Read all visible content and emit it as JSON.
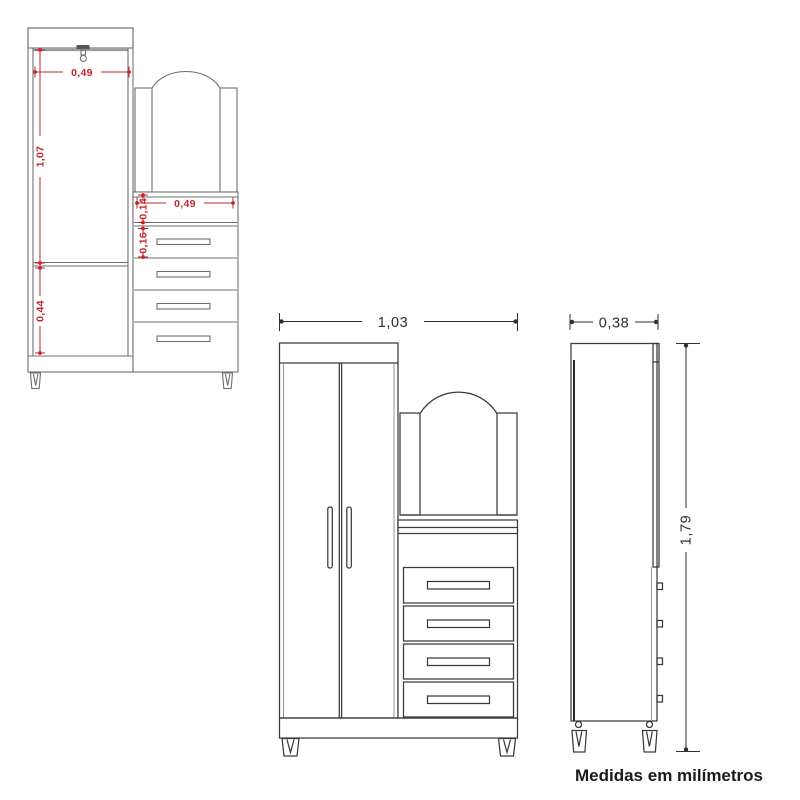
{
  "note": "Medidas em milímetros",
  "colors": {
    "dimension_red": "#c4262c",
    "drawing_dark": "#3a3a3a",
    "drawing_gray": "#6f6f6f",
    "background": "#ffffff"
  },
  "interior_view": {
    "dims": {
      "hang_section_width": "0,49",
      "hang_section_height": "1,07",
      "lower_compartment_height": "0,44",
      "shelf_niche_width": "0,49",
      "shelf_niche_height": "0,14",
      "top_drawer_height": "0,16"
    }
  },
  "front_view": {
    "dims": {
      "total_width": "1,03"
    }
  },
  "side_view": {
    "dims": {
      "total_depth": "0,38",
      "total_height": "1,79"
    }
  }
}
